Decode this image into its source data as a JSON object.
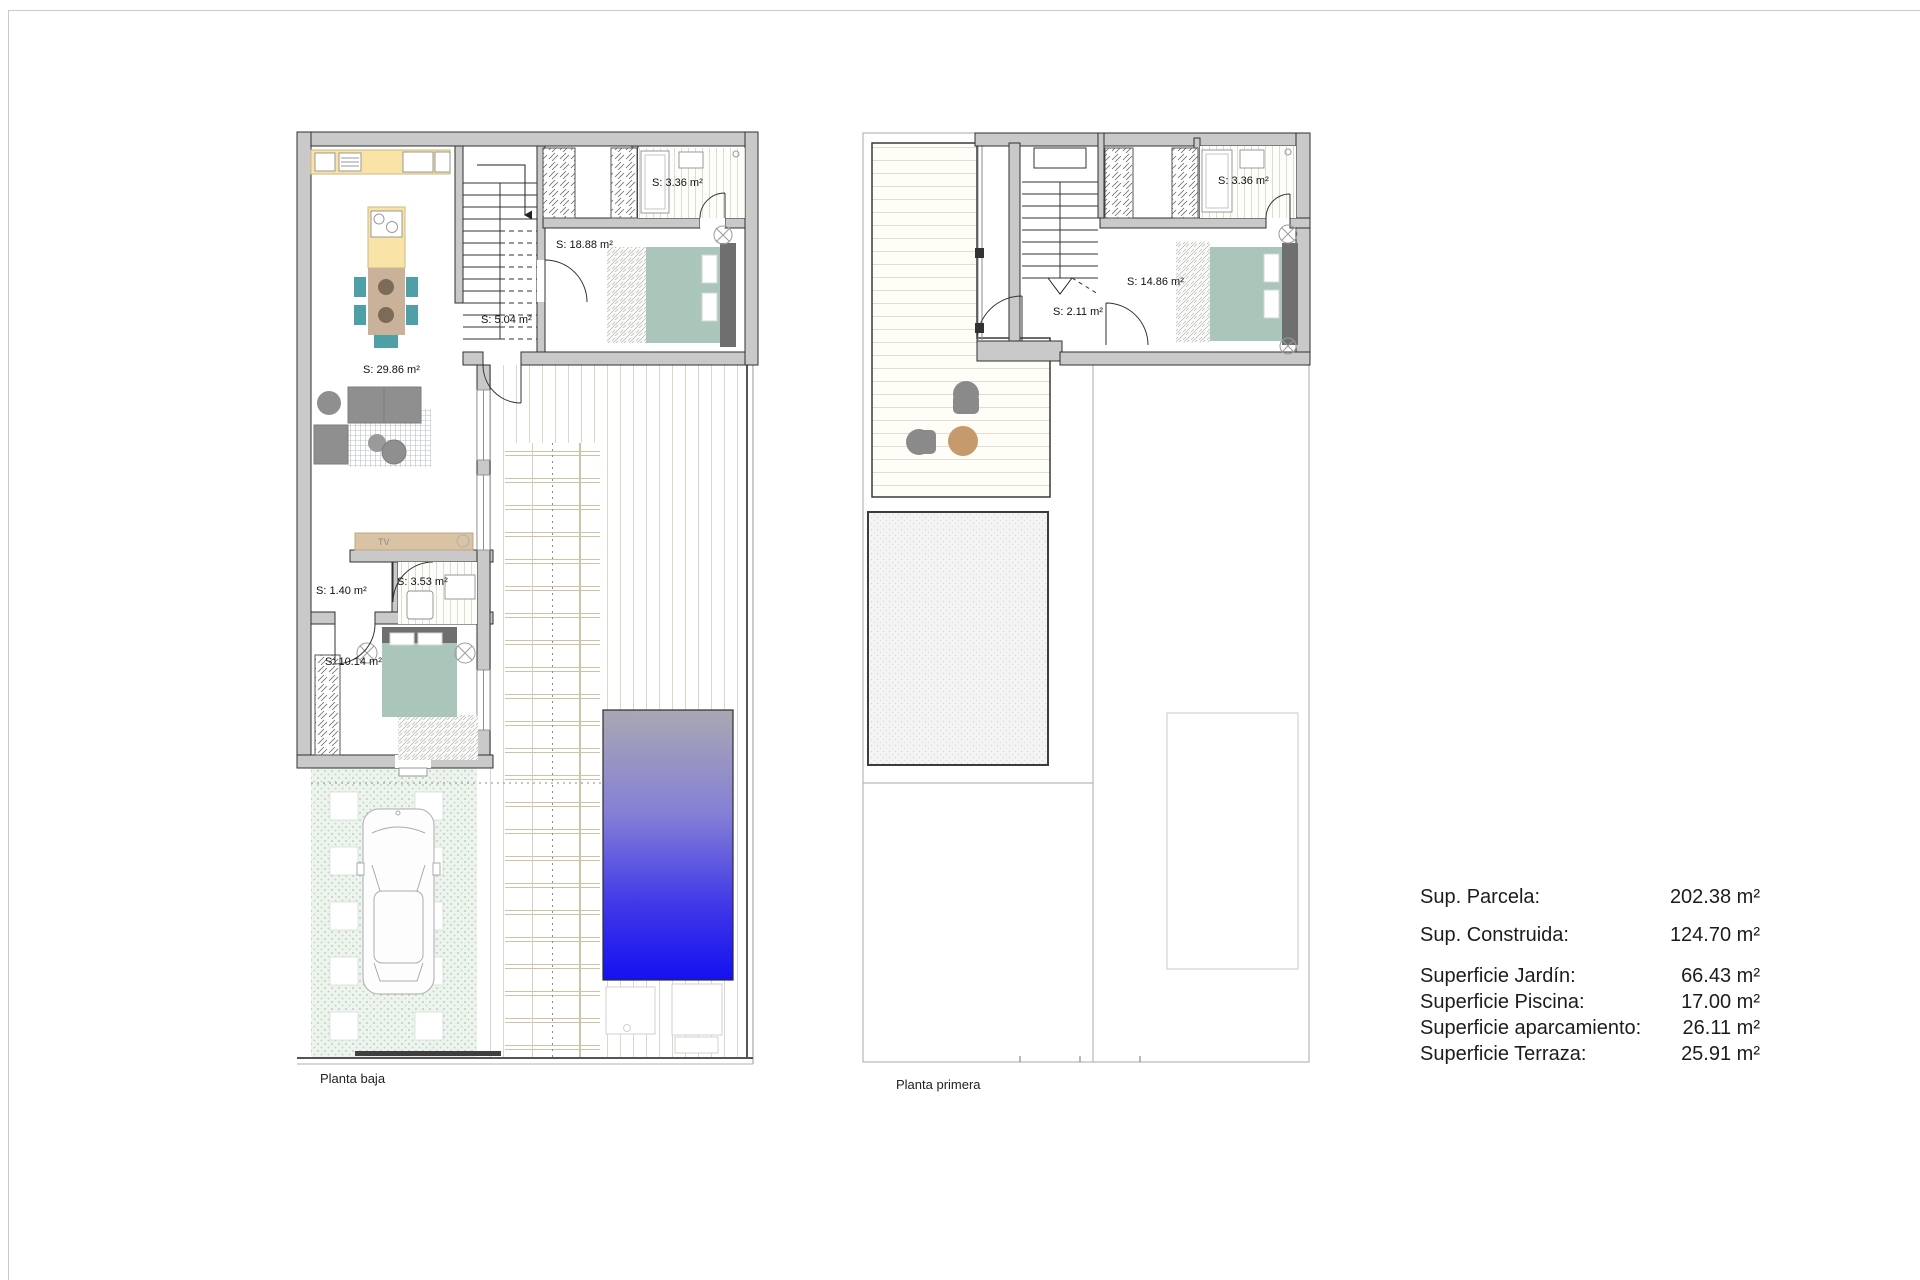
{
  "ground_floor": {
    "caption": "Planta baja",
    "labels": {
      "living": "S: 29.86 m²",
      "hall_upper": "S: 5.04 m²",
      "bedroom_main": "S: 18.88 m²",
      "bathroom_upper": "S: 3.36 m²",
      "hall_lower": "S: 1.40 m²",
      "bathroom_lower": "S: 3.53 m²",
      "bedroom_lower": "S: 10.14 m²",
      "tv": "TV"
    }
  },
  "first_floor": {
    "caption": "Planta primera",
    "labels": {
      "landing": "S: 2.11 m²",
      "bedroom": "S: 14.86 m²",
      "bathroom": "S: 3.36 m²"
    }
  },
  "summary": {
    "rows": [
      {
        "label": "Sup. Parcela:",
        "value": "202.38 m²"
      },
      {
        "label": "Sup. Construida:",
        "value": "124.70 m²"
      },
      {
        "label": "Superficie Jardín:",
        "value": "66.43 m²"
      },
      {
        "label": "Superficie Piscina:",
        "value": "17.00 m²"
      },
      {
        "label": "Superficie aparcamiento:",
        "value": "26.11 m²"
      },
      {
        "label": "Superficie Terraza:",
        "value": "25.91 m²"
      }
    ]
  },
  "colors": {
    "wall_fill": "#c9c9c9",
    "wall_stroke": "#2f2f2f",
    "kitchen_counter": "#fae3a7",
    "table_wood": "#c9b299",
    "plate_brown": "#7b6b57",
    "chair_teal": "#4f9fa8",
    "bed_green": "#aac6bb",
    "headboard_gray": "#6f6f6f",
    "sofa_gray": "#8f8f8f",
    "tv_cabinet_tan": "#d9c3a4",
    "terrace_chair_gray": "#8a8a8a",
    "terrace_table_tan": "#c59a6d",
    "pool_top": "#a8a8b2",
    "pool_bottom": "#1410f0",
    "garden_dot": "#a6c8a6"
  }
}
